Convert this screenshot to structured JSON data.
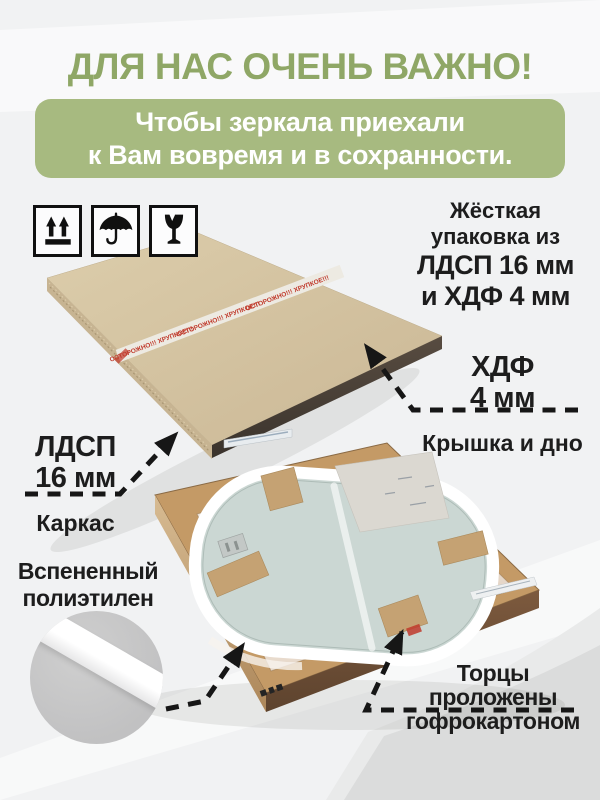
{
  "title": "ДЛЯ НАС ОЧЕНЬ ВАЖНО!",
  "banner": {
    "line1": "Чтобы зеркала приехали",
    "line2": "к Вам вовремя и в сохранности."
  },
  "packaging_icons": [
    "this-side-up",
    "keep-dry",
    "fragile"
  ],
  "annotations": {
    "rigid": {
      "line1": "Жёсткая",
      "line2": "упаковка из",
      "line3": "ЛДСП 16 мм",
      "line4": "и ХДФ 4 мм"
    },
    "hdf": {
      "title1": "ХДФ",
      "title2": "4 мм",
      "caption": "Крышка и дно"
    },
    "ldsp": {
      "title1": "ЛДСП",
      "title2": "16 мм",
      "caption": "Каркас"
    },
    "foam": {
      "line1": "Вспененный",
      "line2": "полиэтилен"
    },
    "edges": {
      "line1": "Торцы",
      "line2": "проложены",
      "line3": "гофрокартоном"
    }
  },
  "photo": {
    "tape_text": "ОСТОРОЖНО!!! ХРУПКОЕ!!!"
  },
  "colors": {
    "title_green": "#8fa766",
    "banner_green": "#a7ba80",
    "text_black": "#1d1d1d",
    "arrow_black": "#161616",
    "package_beige": "#d4c3a0",
    "package_edge_dark": "#4a4139",
    "wood_tan": "#c49a66",
    "mirror_glass": "#cbd7d3",
    "foam_white": "#ffffff",
    "callout_gray": "#c7c7c7",
    "tape_red": "#c0392b"
  }
}
